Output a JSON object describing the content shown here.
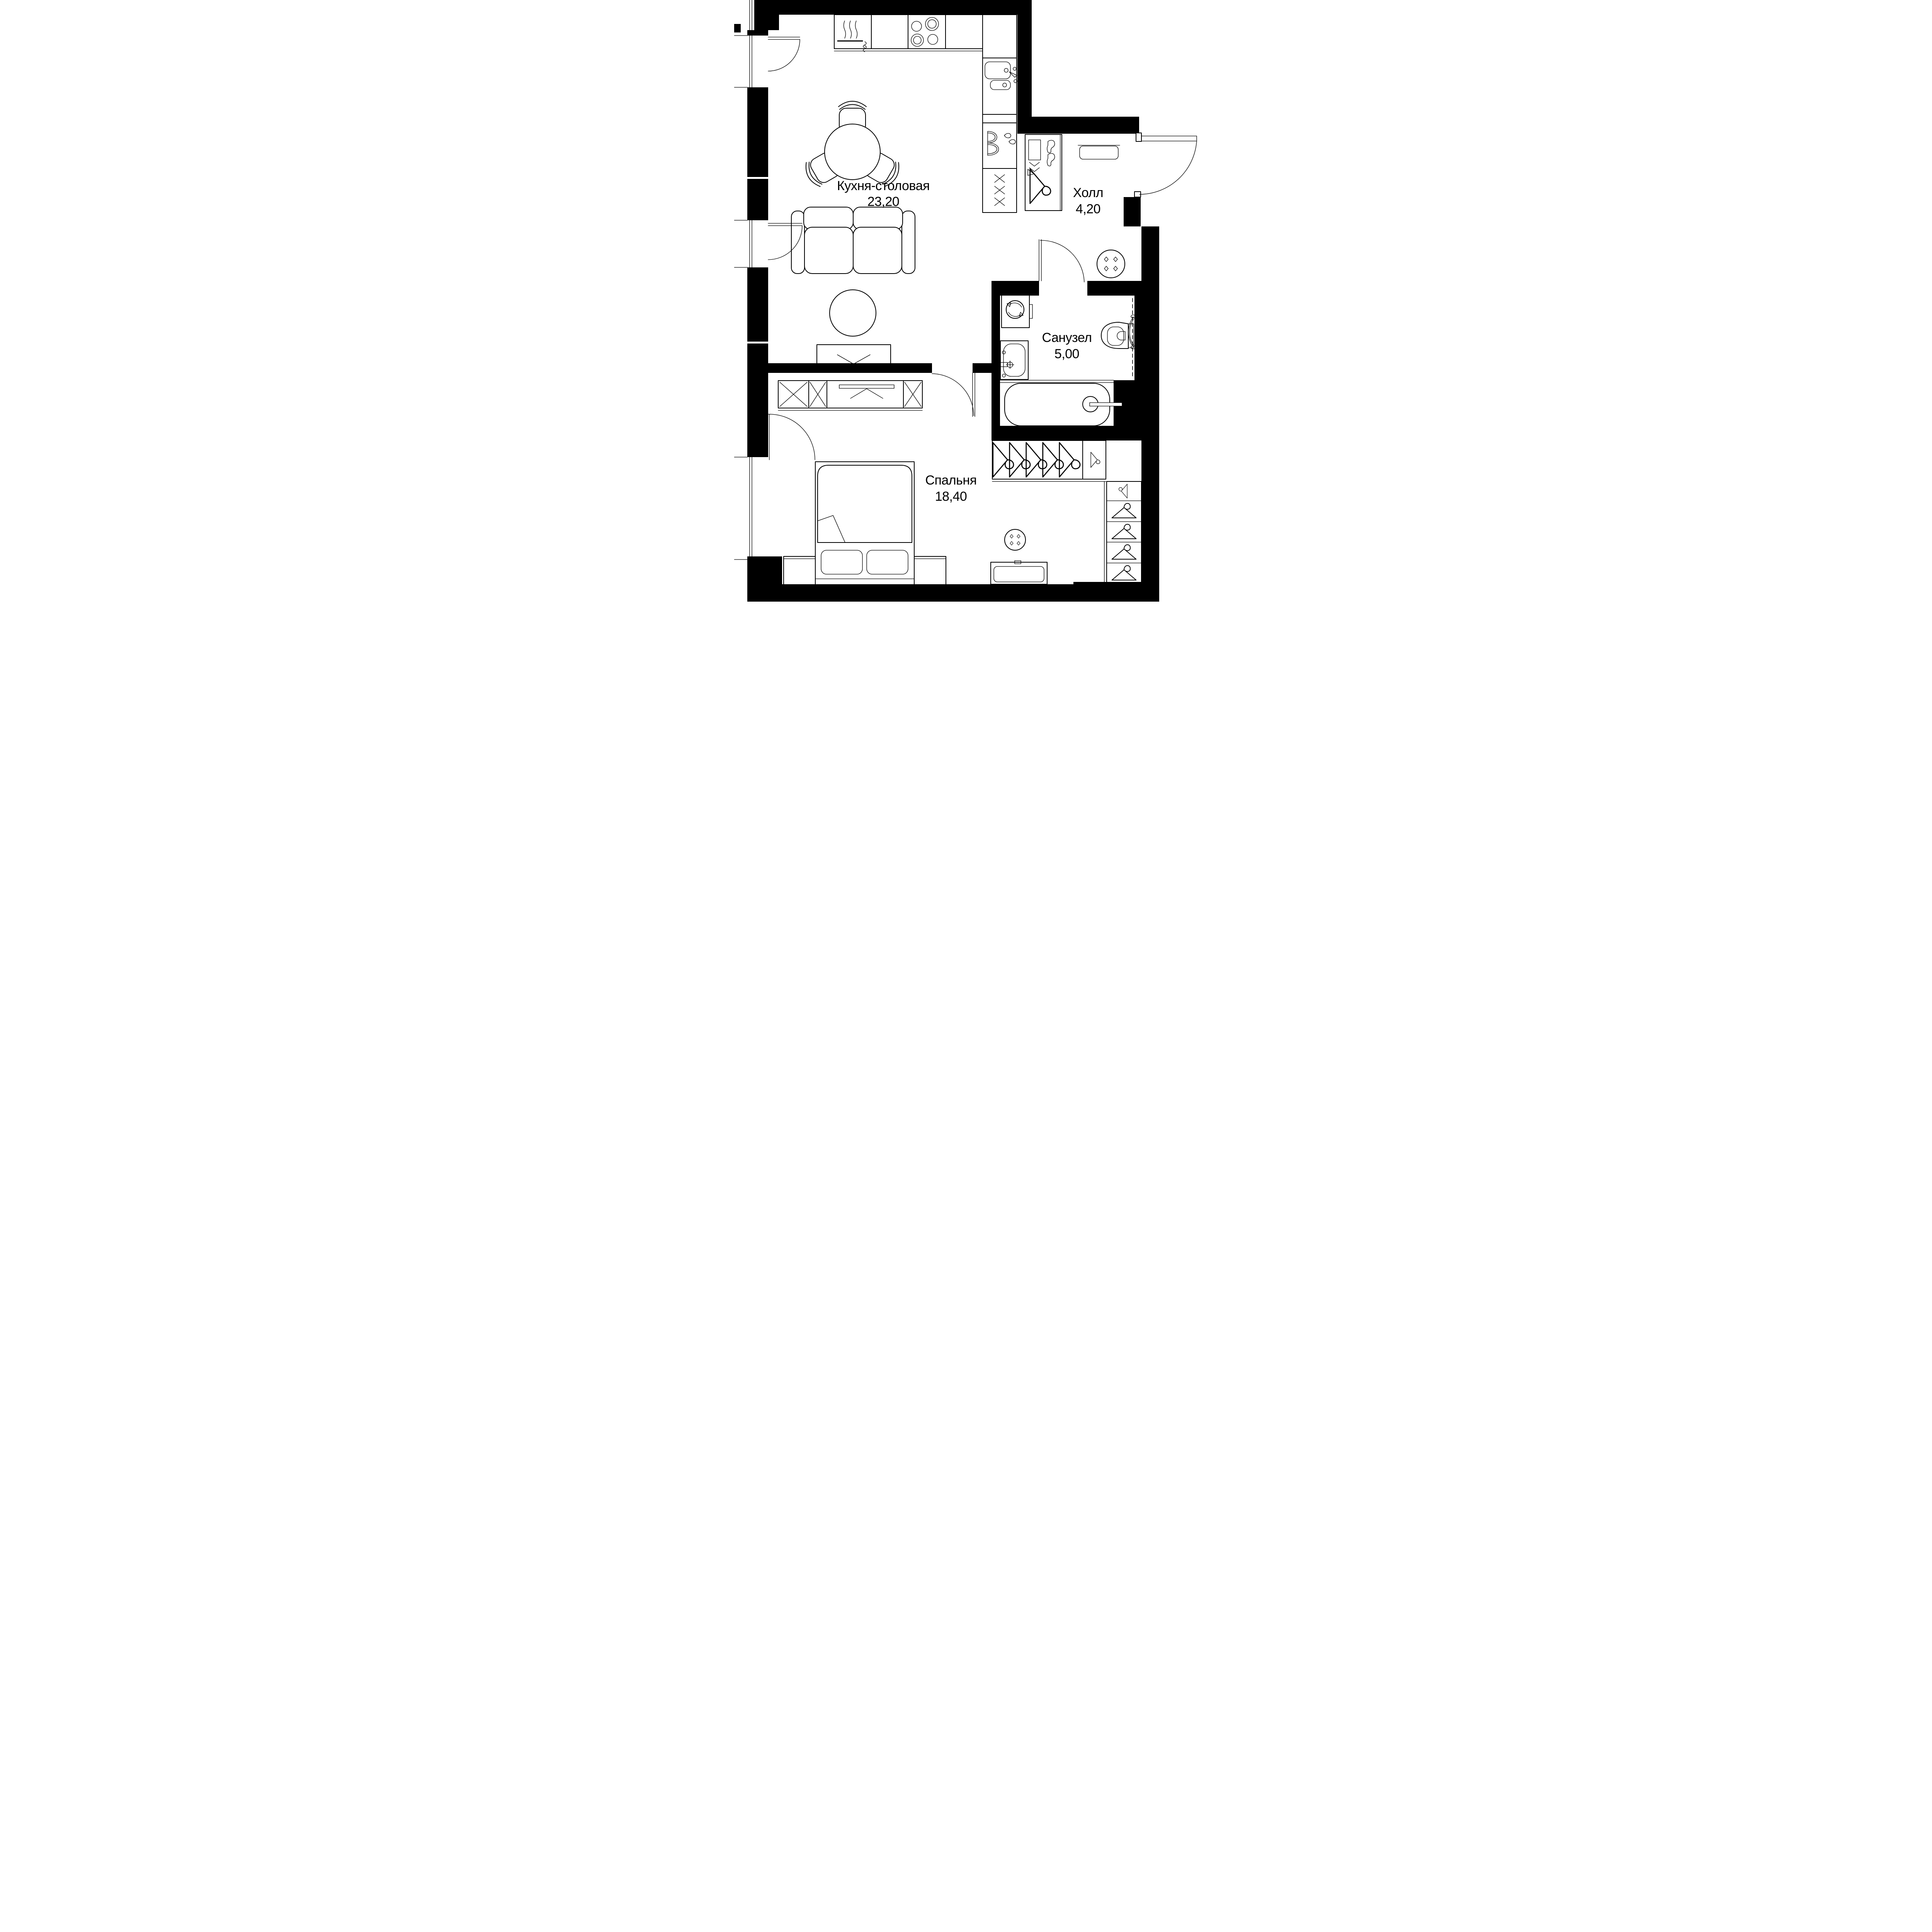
{
  "title": "apartment-floor-plan",
  "colors": {
    "walls": "#000000",
    "lines": "#000000",
    "background": "#ffffff"
  },
  "rooms": [
    {
      "id": "kitchen-dining",
      "name": "Кухня-столовая",
      "area": "23,20"
    },
    {
      "id": "hall",
      "name": "Холл",
      "area": "4,20"
    },
    {
      "id": "bathroom",
      "name": "Санузел",
      "area": "5,00"
    },
    {
      "id": "bedroom",
      "name": "Спальня",
      "area": "18,40"
    }
  ],
  "fixtures": [
    "oven-icon",
    "cooktop-icon",
    "kitchen-sink-icon",
    "refrigerator-icon",
    "pantry-icon",
    "dining-table-icon",
    "chair-icon",
    "sofa-icon",
    "pouf-icon",
    "tv-icon",
    "tv-console-icon",
    "coat-closet-icon",
    "shoe-rack-icon",
    "hanger-icon",
    "doormat-icon",
    "entrance-door-icon",
    "interior-door-icon",
    "window-icon",
    "washing-machine-icon",
    "washbasin-icon",
    "toilet-icon",
    "towel-radiator-icon",
    "bathtub-icon",
    "bed-icon",
    "pillow-icon",
    "nightstand-icon",
    "dresser-icon",
    "stool-icon",
    "side-table-icon",
    "wardrobe-icon"
  ]
}
